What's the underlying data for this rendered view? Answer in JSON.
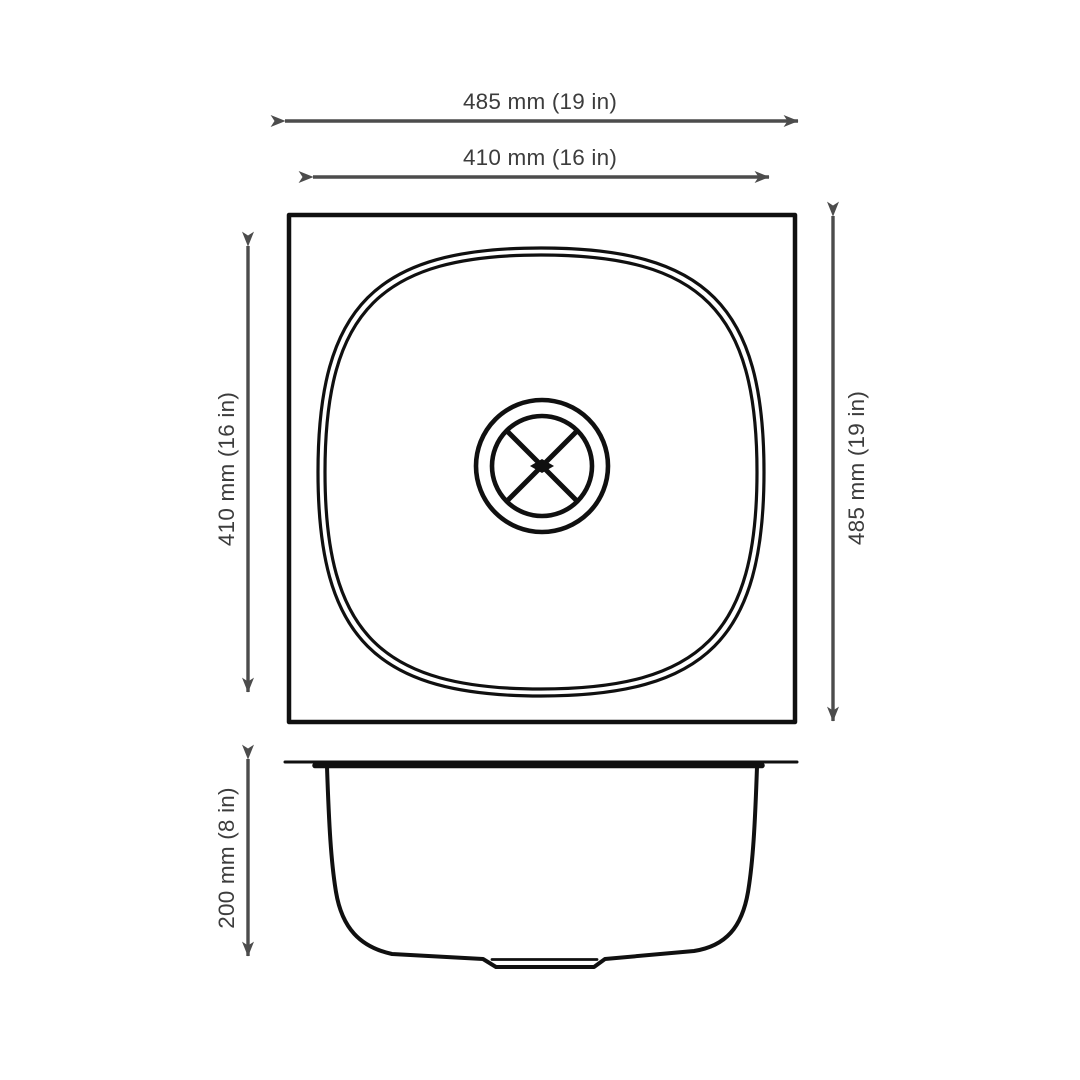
{
  "colors": {
    "background": "#ffffff",
    "line": "#101010",
    "dimension": "#4c4c4c",
    "text": "#3c3c3c"
  },
  "diagram": {
    "dimensions": {
      "outer_width": {
        "label": "485 mm (19 in)",
        "mm": 485,
        "inches": 19
      },
      "bowl_width": {
        "label": "410 mm (16 in)",
        "mm": 410,
        "inches": 16
      },
      "bowl_length": {
        "label": "410 mm (16 in)",
        "mm": 410,
        "inches": 16
      },
      "outer_length": {
        "label": "485 mm (19 in)",
        "mm": 485,
        "inches": 19
      },
      "depth": {
        "label": "200 mm (8 in)",
        "mm": 200,
        "inches": 8
      }
    }
  }
}
